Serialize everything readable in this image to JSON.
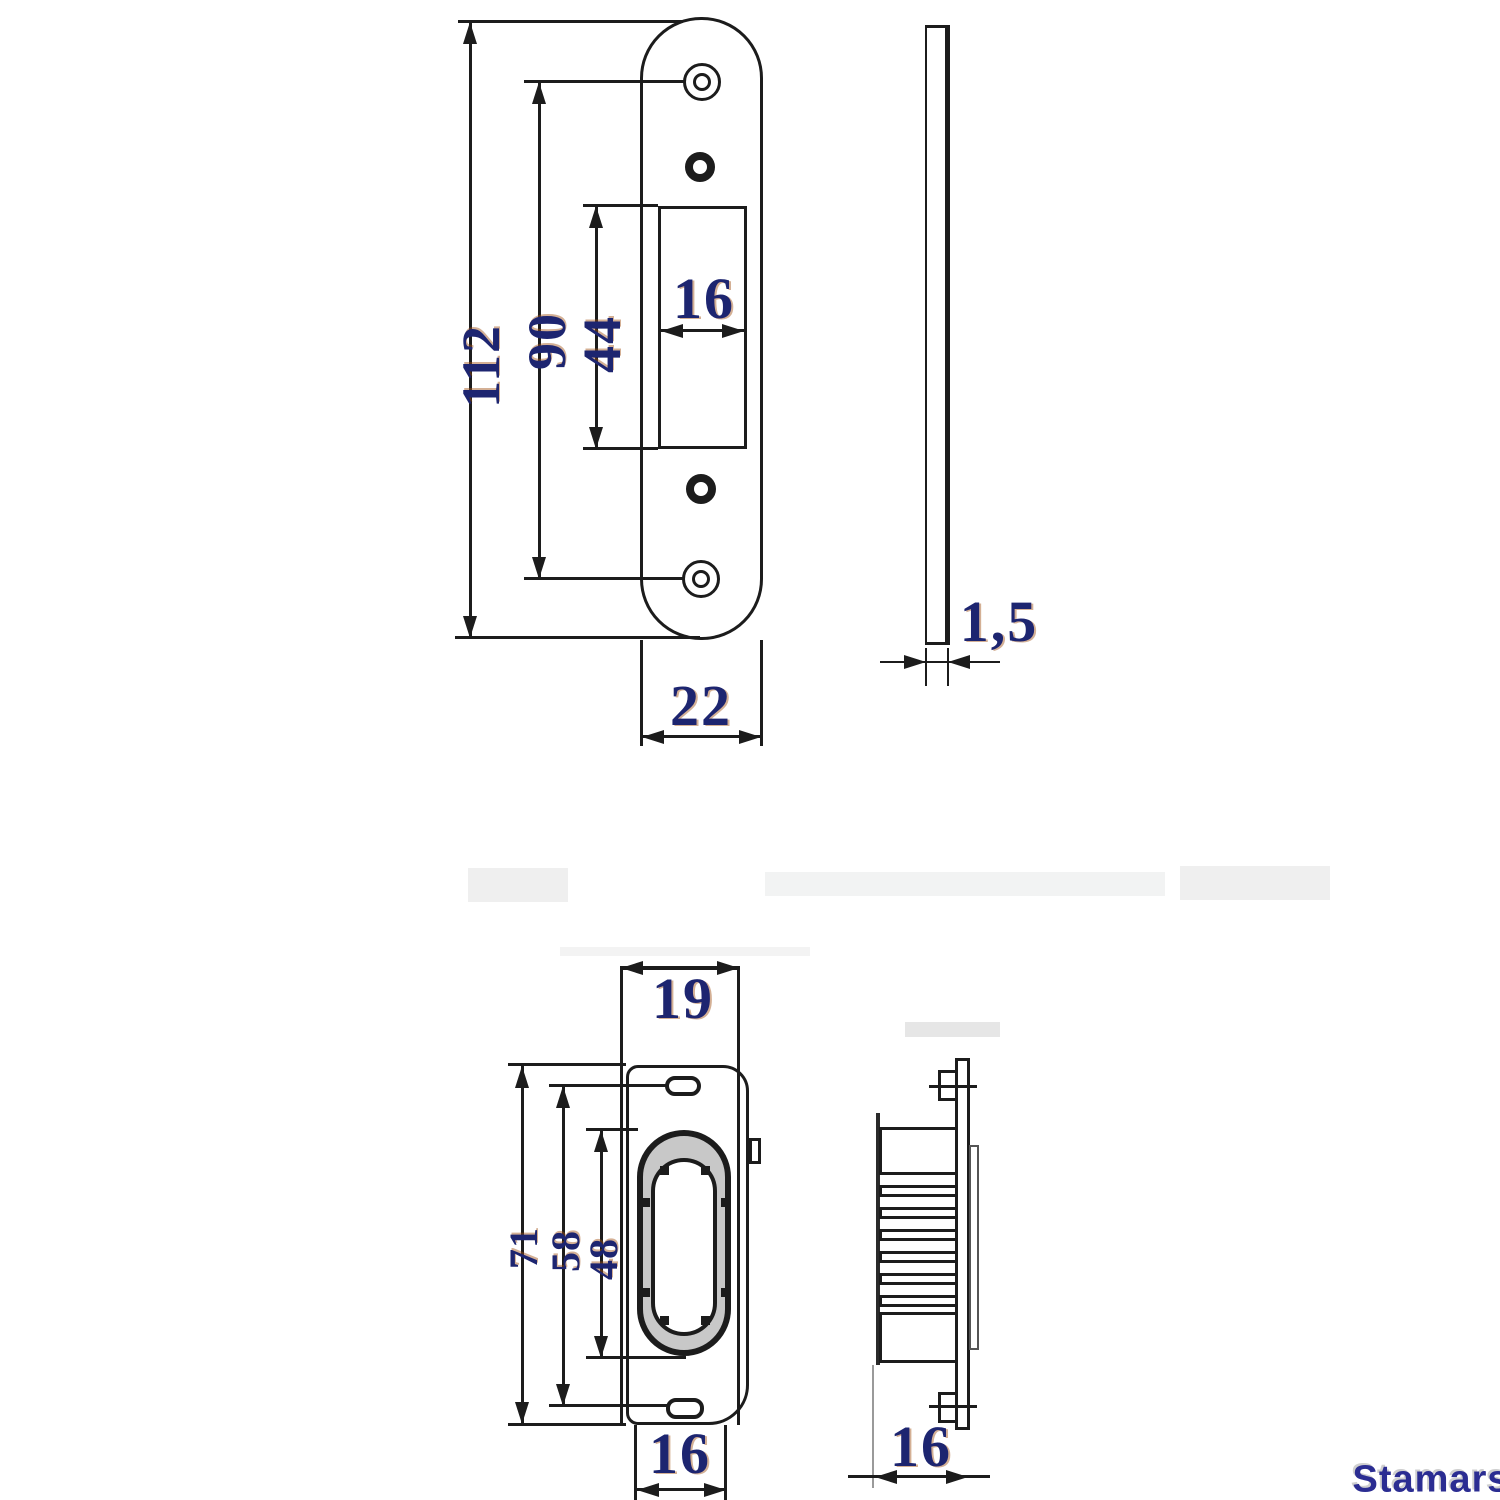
{
  "drawing": {
    "front_plate": {
      "height": "112",
      "screw_span": "90",
      "cutout_height": "44",
      "cutout_width": "16",
      "width": "22"
    },
    "side_plate": {
      "thickness": "1,5"
    },
    "keep_front": {
      "width": "19",
      "height": "71",
      "slot_span": "58",
      "pocket_height": "48",
      "box_width": "16"
    },
    "keep_side": {
      "depth": "16"
    }
  },
  "watermark": "Stamars",
  "colors": {
    "line": "#1c1c1c",
    "dim_text": "#1d2570",
    "watermark": "#2b2d92"
  }
}
